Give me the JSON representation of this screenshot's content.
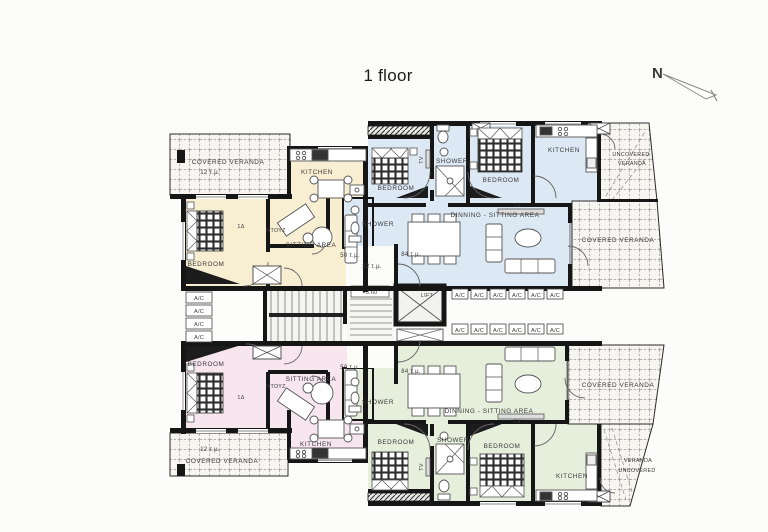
{
  "page": {
    "title": "1 floor",
    "watermark": "KASIS"
  },
  "compass": {
    "north_label": "N"
  },
  "core": {
    "lift_label": "LIFT",
    "level_label": "+3.60",
    "lobby_area": "22 τ.μ.",
    "ac_label": "A/C"
  },
  "apartment_top_left": {
    "veranda_label": "COVERED VERANDA",
    "veranda_area": "12 τ.μ.",
    "kitchen_label": "KITCHEN",
    "bedroom_label": "BEDROOM",
    "hall_label": "1Δ",
    "shower_label": "ΝΤΟΥΖ",
    "sitting_label": "SITTING AREA",
    "area_label": "50 τ.μ."
  },
  "apartment_top_right": {
    "bedroom1_label": "BEDROOM",
    "bedroom2_label": "BEDROOM",
    "shower1_label": "SHOWER",
    "shower2_label": "SHOWER",
    "kitchen_label": "KITCHEN",
    "tv_bedroom_label": "TV",
    "living_label": "DINNING - SITTING AREA",
    "tv_label": "TV",
    "area_label": "84 τ.μ.",
    "uncovered_veranda_line1": "UNCOVERED",
    "uncovered_veranda_line2": "VERANDA",
    "covered_veranda_label": "COVERED VERANDA"
  },
  "apartment_bottom_left": {
    "veranda_area": "12 τ.μ.",
    "veranda_label": "COVERED VERANDA",
    "kitchen_label": "KITCHEN",
    "bedroom_label": "BEDROOM",
    "hall_label": "1Δ",
    "shower_label": "ΝΤΟΥΖ",
    "sitting_label": "SITTING AREA",
    "area_label": "50 τ.μ."
  },
  "apartment_bottom_right": {
    "bedroom1_label": "BEDROOM",
    "bedroom2_label": "BEDROOM",
    "shower1_label": "SHOWER",
    "shower2_label": "SHOWER",
    "kitchen_label": "KITCHEN",
    "tv_bedroom_label": "TV",
    "living_label": "DINNING - SITTING AREA",
    "tv_label": "TV",
    "area_label": "84 τ.μ.",
    "covered_veranda_label": "COVERED VERANDA",
    "uncovered_veranda_line1": "VERANDA",
    "uncovered_veranda_line2": "UNCOVERED"
  },
  "colors": {
    "cream": "#f8eed2",
    "blue": "#dce8f4",
    "pink": "#f7e6ee",
    "green": "#e6efdc",
    "wall": "#161616",
    "north": "#c03b33"
  }
}
